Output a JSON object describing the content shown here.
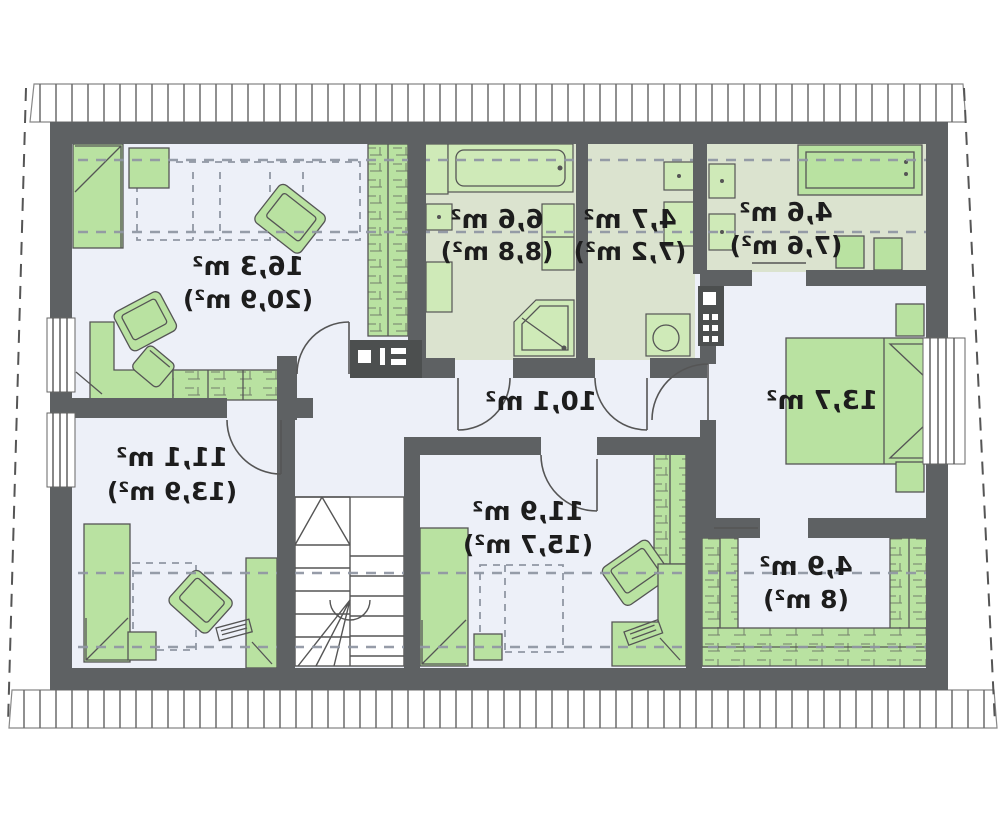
{
  "plan": {
    "title": "attic-floor-plan",
    "unit": "m²",
    "text_mirrored": true,
    "rooms": [
      {
        "name": "bedroom-large",
        "net": "16,3 m²",
        "gross": "(20,9 m²)"
      },
      {
        "name": "bathroom",
        "net": "6,6 m²",
        "gross": "(8,8 m²)"
      },
      {
        "name": "wc",
        "net": "4,7 m²",
        "gross": "(7,2 m²)"
      },
      {
        "name": "utility-room",
        "net": "4,6 m²",
        "gross": "(7,6 m²)"
      },
      {
        "name": "bedroom-right",
        "net": "13,7 m²",
        "gross": ""
      },
      {
        "name": "walk-in-closet",
        "net": "4,9 m²",
        "gross": "(8 m²)"
      },
      {
        "name": "bedroom-bottom-center",
        "net": "11,9 m²",
        "gross": "(15,7 m²)"
      },
      {
        "name": "bedroom-bottom-left",
        "net": "11,1 m²",
        "gross": "(13,9 m²)"
      },
      {
        "name": "hall",
        "net": "10,1 m²",
        "gross": ""
      }
    ],
    "colors": {
      "wall": "#5e6163",
      "furniture_green": "#b9e2a1",
      "fixture_green": "#cfeab8",
      "bath_floor": "#dbe3cf",
      "room_floor": "#edf0f8",
      "dash": "#9097a3",
      "line": "#555555",
      "roof_hatch": "#6a6a6a",
      "text": "#1d1d1d"
    }
  }
}
